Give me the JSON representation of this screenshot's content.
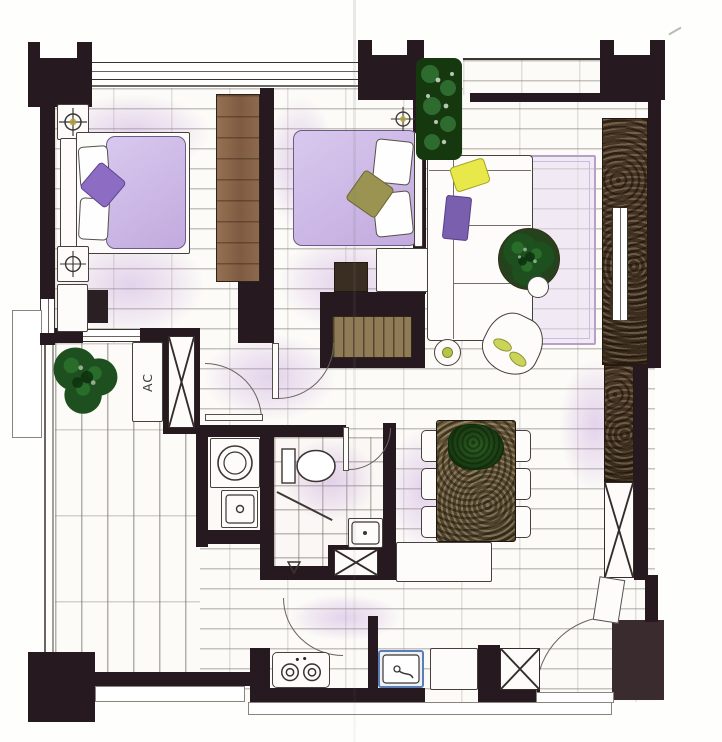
{
  "plan": {
    "title": "apartment-floor-plan-watercolor",
    "labels": {
      "ac_unit": "AC"
    },
    "palette": {
      "wall": "#261a20",
      "floor_line": "#8a8178",
      "lavender_tint": "#be96d7",
      "mattress": "#c9b4e2",
      "pillow_purple": "#8d6cc3",
      "pillow_yellow": "#e9e84b",
      "pillow_olive": "#9a9352",
      "plant_green": "#235c24",
      "wood_closet": "#8d6b50",
      "feature_wall_brown": "#47321f",
      "dining_table_wood": "#5c4c30",
      "kitchen_sink_blue": "#5b7fb5",
      "rug_lavender": "#e7ddf1",
      "lamp_olive": "#b3a23f"
    },
    "fixtures": {
      "bedroom_left": [
        "double-bed",
        "wardrobe",
        "nightstand-lamp",
        "bench"
      ],
      "bedroom_middle": [
        "double-bed",
        "nightstand",
        "media-shelf"
      ],
      "living_room": [
        "l-shaped-sofa",
        "coffee-table-plant",
        "rug",
        "lounge-chair",
        "side-table",
        "tall-plant"
      ],
      "dining_room": [
        "dining-table",
        "six-chairs",
        "sideboard"
      ],
      "bathroom": [
        "toilet",
        "shower",
        "wash-basin",
        "duct-shaft"
      ],
      "utility": [
        "washing-machine",
        "laundry-sink"
      ],
      "kitchen": [
        "two-burner-stove",
        "kitchen-sink",
        "cabinet",
        "fridge-shaft"
      ],
      "balcony": [
        "wood-deck",
        "shrubs",
        "ac-unit",
        "railing"
      ]
    }
  }
}
